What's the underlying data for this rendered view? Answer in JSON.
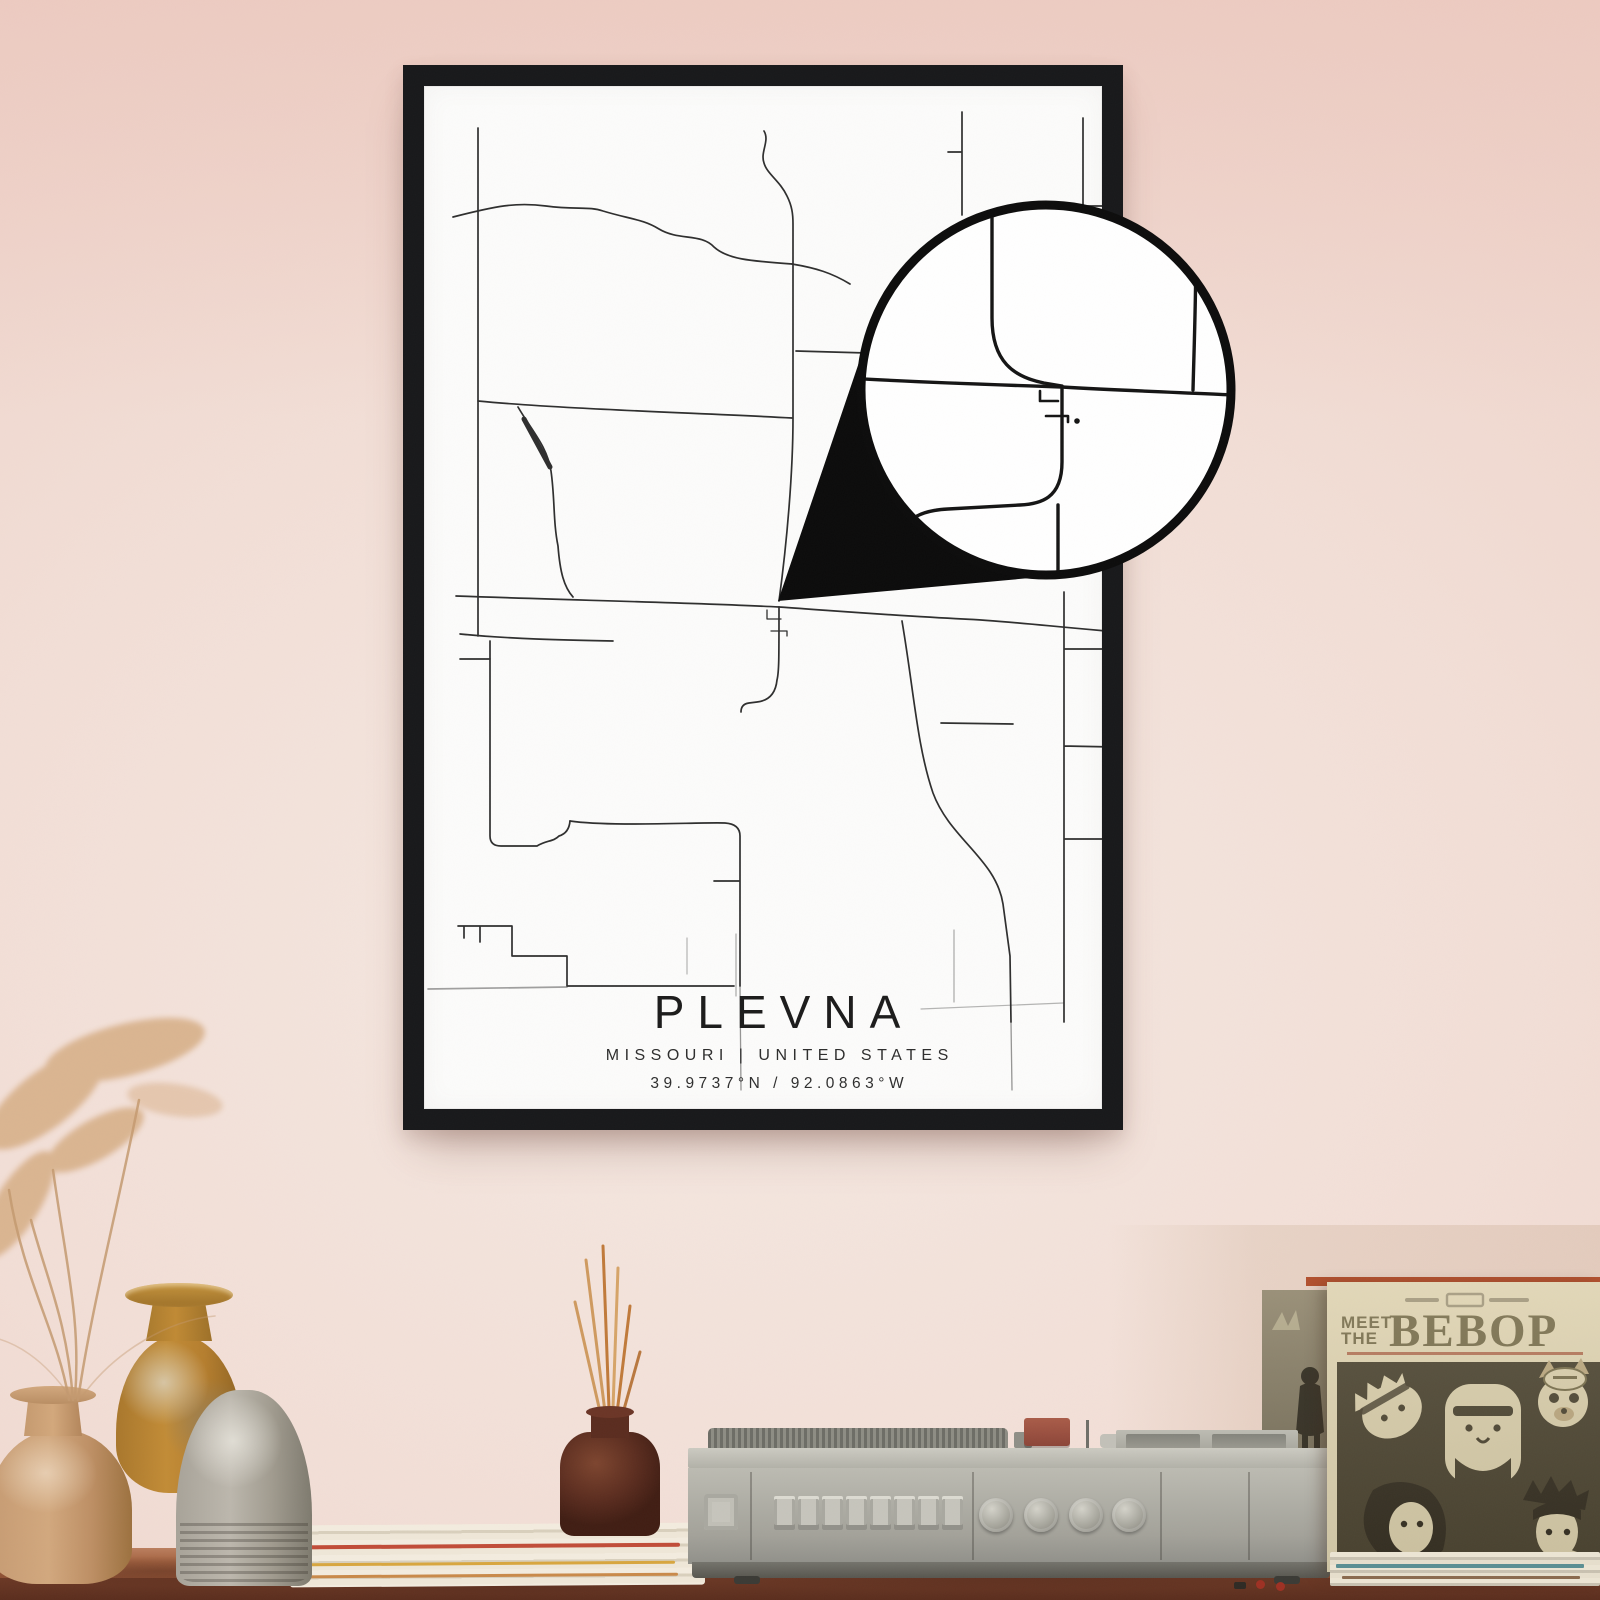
{
  "poster": {
    "title": "PLEVNA",
    "subtitle": "MISSOURI | UNITED STATES",
    "coordinates": "39.9737°N / 92.0863°W",
    "frame_color": "#17181a",
    "paper_color": "#fcfcfb",
    "road_color": "#2e2e2e"
  },
  "magnifier": {
    "border_color": "#0c0c0c",
    "fill_color": "#ffffff",
    "wedge_color": "#0b0b0b"
  },
  "album": {
    "header_line1": "MEET",
    "header_line2": "THE",
    "title": "BEBOP",
    "cover_bg": "#ded5b5",
    "ink_color": "#6f6747",
    "panel_color": "#3f3a2a"
  },
  "wall": {
    "top_color": "#ecc7bd",
    "mid_color": "#f2ded6",
    "low_color": "#eed6cb"
  },
  "shelf": {
    "wood_top_color": "#a2613f",
    "wood_front_color": "#5e3122"
  },
  "objects": {
    "left_cluster": [
      "pampas-grass",
      "amber-vase",
      "tan-vase",
      "gray-ribbed-vase"
    ],
    "center": [
      "magazine-stack",
      "reed-diffuser-bottle",
      "vintage-turntable"
    ],
    "right": [
      "record-sleeve-backing",
      "bebop-album-cover",
      "record-stack"
    ]
  }
}
